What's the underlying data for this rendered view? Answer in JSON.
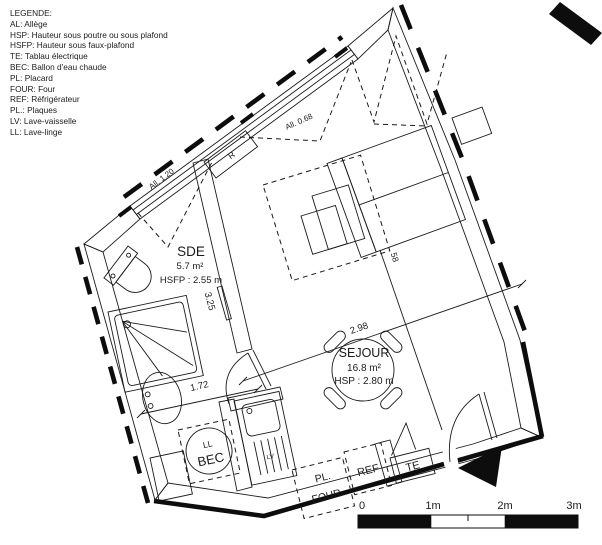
{
  "legend": {
    "title": "LEGENDE:",
    "items": [
      "AL: Allège",
      "HSP: Hauteur sous poutre ou sous plafond",
      "HSFP: Hauteur sous faux-plafond",
      "TE: Tablau électrique",
      "BEC: Ballon d'eau chaude",
      "PL: Placard",
      "FOUR: Four",
      "REF: Réfrigérateur",
      "PL.: Plaques",
      "LV: Lave-vaisselle",
      "LL: Lave-linge"
    ]
  },
  "rooms": {
    "sde": {
      "name": "SDE",
      "area": "5.7 m²",
      "ceiling": "HSFP : 2.55 m"
    },
    "sejour": {
      "name": "SEJOUR",
      "area": "16.8 m²",
      "ceiling": "HSP : 2.80 m"
    }
  },
  "labels": {
    "bec": "BEC",
    "ll": "LL",
    "lv": "LV",
    "pl": "PL.",
    "four": "FOUR",
    "ref": "REF",
    "te": "TE",
    "radiator": "R"
  },
  "dimensions": {
    "sde_depth": "3.25",
    "sde_width": "1.72",
    "sejour_width": "2.98",
    "closet": "58",
    "sill_left": "All. 1.20",
    "sill_top": "All. 0.68"
  },
  "scale_bar": {
    "t0": "0",
    "t1": "1m",
    "t2": "2m",
    "t3": "3m"
  }
}
